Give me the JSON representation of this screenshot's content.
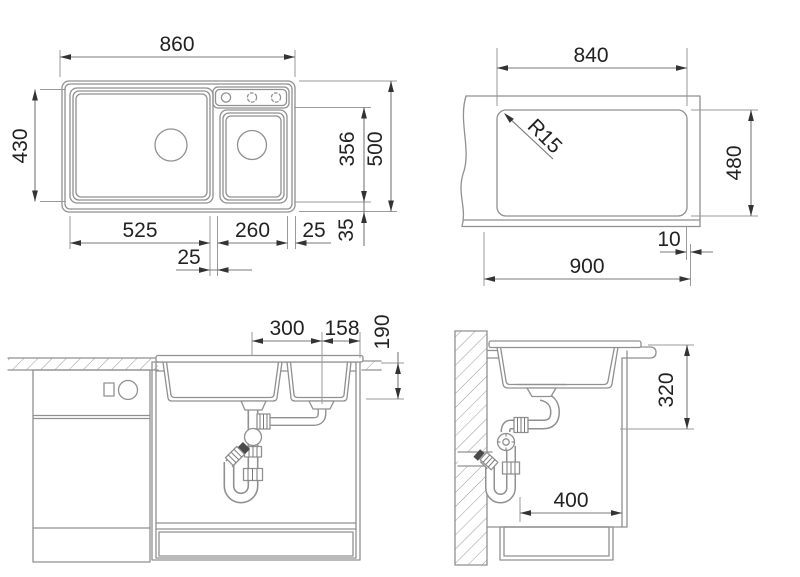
{
  "drawing": {
    "description": "Kitchen sink installation technical drawing, four orthographic views",
    "views": {
      "top_view": {
        "dims": {
          "overall_width": "860",
          "left_depth": "430",
          "overall_depth": "500",
          "bowl_inner_depth": "356",
          "bottom_edge": "35",
          "main_bowl_width": "525",
          "small_bowl_width": "260",
          "right_edge": "25",
          "divider_offset": "25"
        }
      },
      "cutout_view": {
        "dims": {
          "cutout_width": "840",
          "corner_radius": "R15",
          "cutout_depth": "480",
          "edge_offset": "10",
          "min_cabinet_width": "900"
        }
      },
      "front_view": {
        "dims": {
          "drain_spacing": "300",
          "drain_to_edge": "158",
          "bowl_depth": "190"
        }
      },
      "side_view": {
        "dims": {
          "installation_depth": "320",
          "clearance_width": "400"
        }
      }
    }
  }
}
